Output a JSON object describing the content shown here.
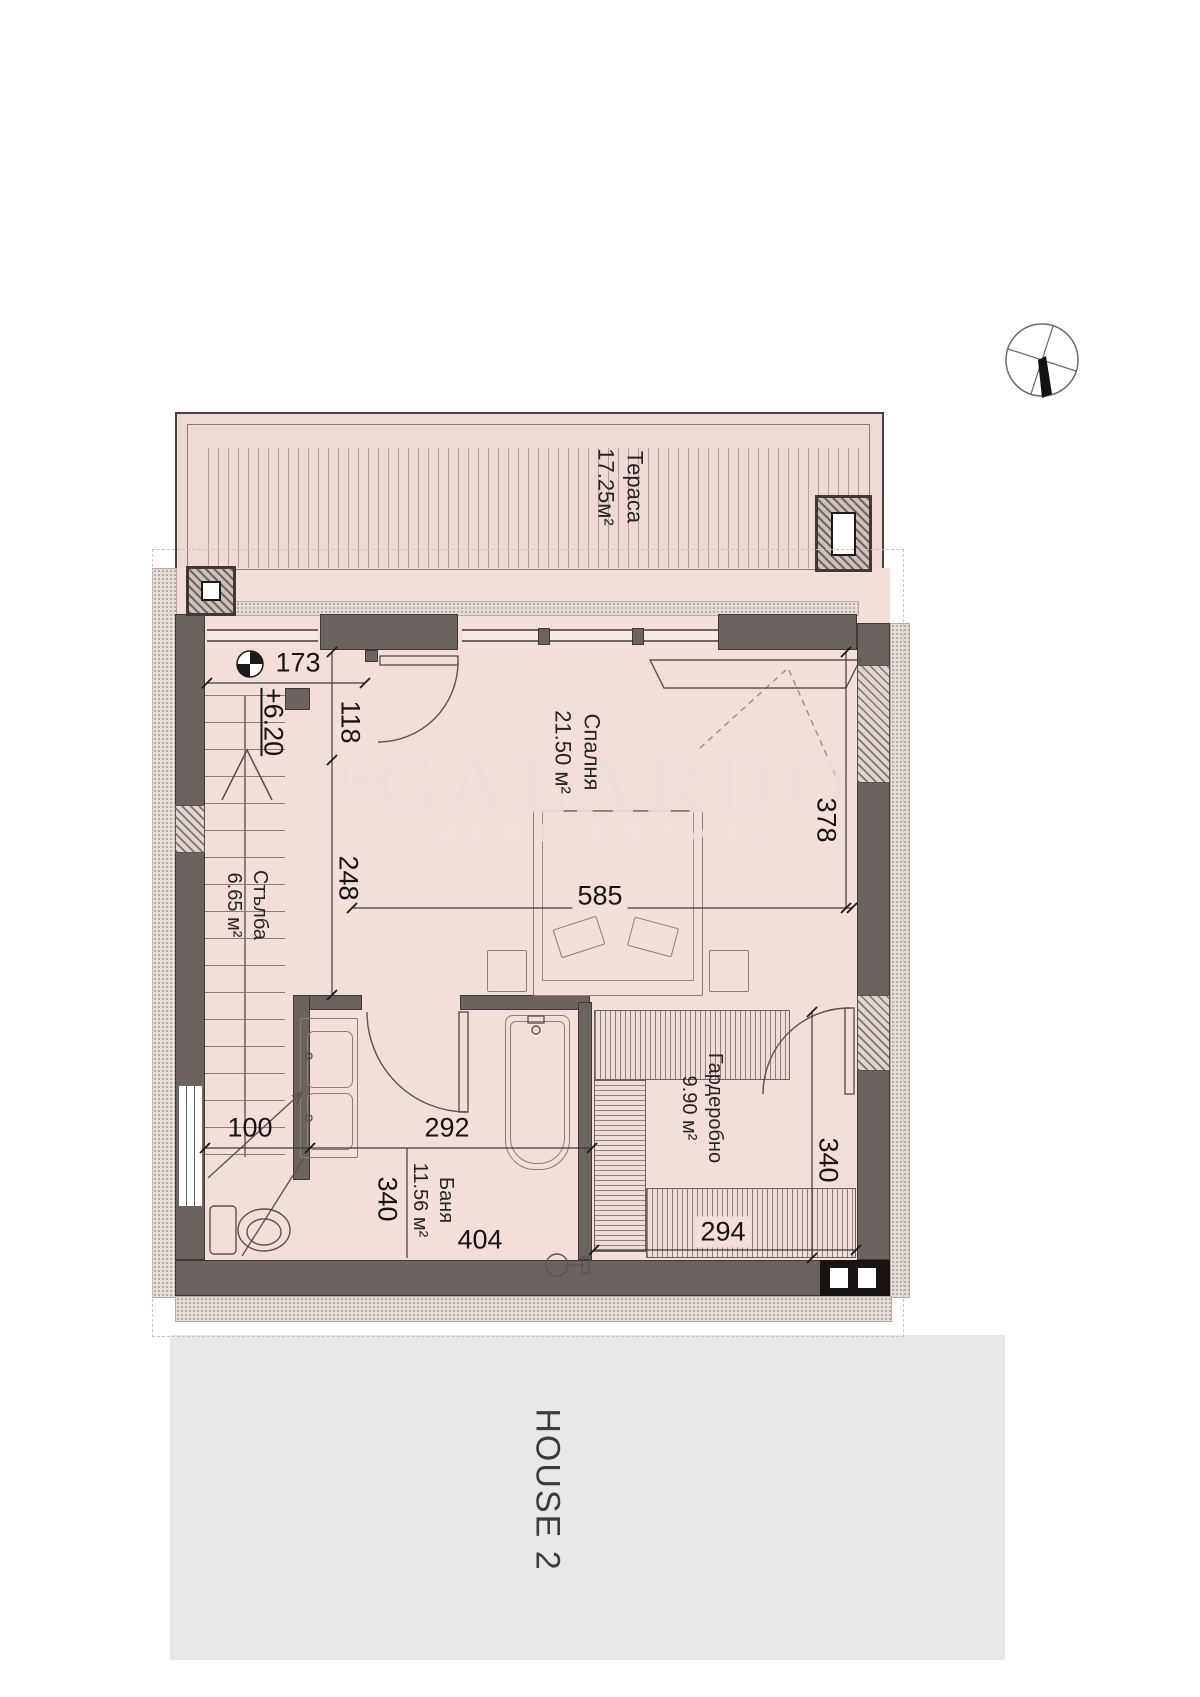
{
  "rooms": {
    "terrace": {
      "name": "Тераса",
      "area": "17.25м²"
    },
    "bedroom": {
      "name": "Спалня",
      "area": "21.50 м²"
    },
    "stairs": {
      "name": "Стълба",
      "area": "6.65 м²"
    },
    "bathroom": {
      "name": "Баня",
      "area": "11.56 м²"
    },
    "wardrobe": {
      "name": "Гардеробно",
      "area": "9.90 м²"
    }
  },
  "dimensions": {
    "d173": "173",
    "d118": "118",
    "d248": "248",
    "d585": "585",
    "d378": "378",
    "d100": "100",
    "d292": "292",
    "d340_bath": "340",
    "d404": "404",
    "d294": "294",
    "d340_wardrobe": "340",
    "elevation": "+6.20"
  },
  "watermark": {
    "brand": "GALARDO",
    "tagline": "REAL ESTATE"
  },
  "site": {
    "house_label": "HOUSE 2"
  },
  "colors": {
    "floor": "#f2dfda",
    "terrace": "#eed9d4",
    "wall": "#6b6360",
    "site_block": "#e8e8e8",
    "watermark": "#ecdfdc"
  }
}
